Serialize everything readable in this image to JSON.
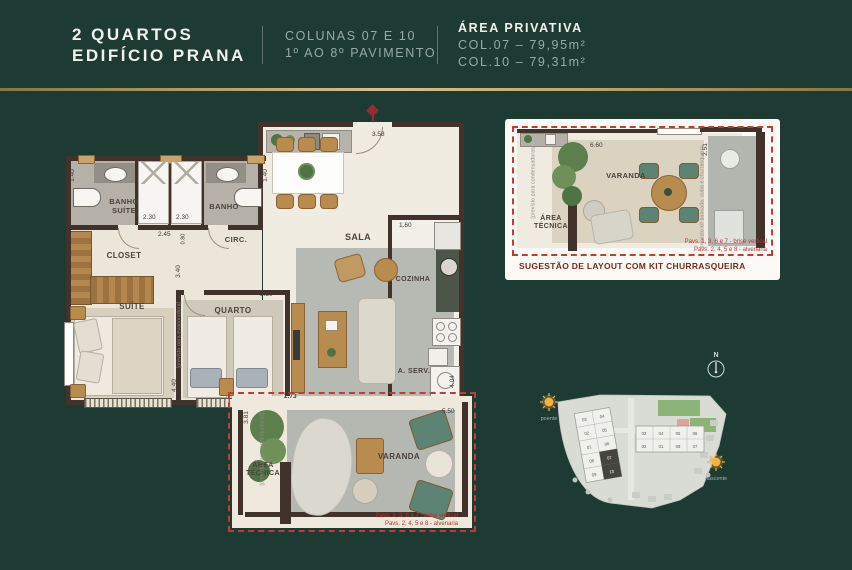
{
  "header": {
    "title_line1": "2 QUARTOS",
    "title_line2": "EDIFÍCIO PRANA",
    "columns_line1": "COLUNAS 07 E 10",
    "columns_line2": "1º AO 8º PAVIMENTO",
    "area_title": "ÁREA PRIVATIVA",
    "area_col07": "COL.07 – 79,95m²",
    "area_col10": "COL.10 – 79,31m²"
  },
  "plan": {
    "rooms": {
      "banho_suite": "BANHO SUÍTE",
      "banho": "BANHO",
      "circ": "CIRC.",
      "closet": "CLOSET",
      "sala": "SALA",
      "suite": "SUÍTE",
      "quarto": "QUARTO",
      "cozinha": "COZINHA",
      "aserv": "A. SERV.",
      "varanda": "VARANDA",
      "area_tecnica": "ÁREA TÉCNICA"
    },
    "dims": {
      "banho_suite_w": "1.40",
      "box_left": "2.30",
      "box_right": "2.30",
      "banho_w": "1.40",
      "circ_w": "2.45",
      "hall_h": "0.80",
      "quarto_depth": "3.40",
      "entry_w": "3.58",
      "cozinha_w": "1.60",
      "quarto_w": "2.50",
      "suite_depth": "4.40",
      "aserv_depth": "4.04",
      "varanda_offset": "2.73",
      "varanda_w": "5.50",
      "varanda_d": "3.81"
    },
    "notes": {
      "evaporadora": "[previsto para evaporadora]",
      "condensadoras": "[previsto para condensadoras]",
      "pav1": "Pavs. 1, 3, 6 e 7 - brise vertical",
      "pav2": "Pavs. 2, 4, 5 e 8 - alvenaria"
    }
  },
  "detail_panel": {
    "caption": "SUGESTÃO DE LAYOUT COM KIT CHURRASQUEIRA",
    "varanda_label": "VARANDA",
    "area_tecnica_label": "ÁREA TÉCNICA",
    "dim_width": "6.60",
    "dim_depth": "2.51",
    "note_left": "[previsto para condensadoras]",
    "note_right": "previsto kit bancada, cuba e churrasqueira",
    "pav1": "Pavs. 1, 3, 6 e 7 - brise vertical",
    "pav2": "Pavs. 2, 4, 5 e 8 - alvenaria"
  },
  "site_plan": {
    "compass_label": "N",
    "sun_west_label": "poente",
    "sun_east_label": "nascente",
    "left_building_units": [
      "03",
      "04",
      "02",
      "05",
      "01",
      "06",
      "08",
      "07",
      "09",
      "10"
    ],
    "right_building_units": [
      "03",
      "04",
      "05",
      "06",
      "02",
      "01",
      "08",
      "07"
    ],
    "highlighted_units": [
      "07",
      "10"
    ]
  }
}
